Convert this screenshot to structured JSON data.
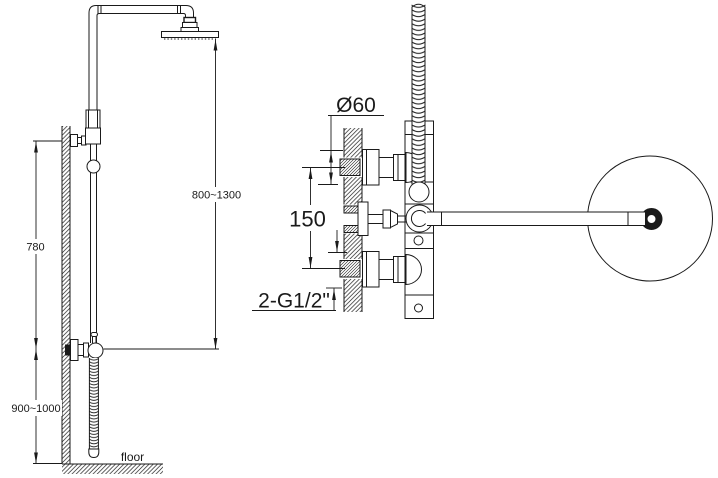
{
  "labels": {
    "side": {
      "bracket_height": "780",
      "head_height_range": "800~1300",
      "valve_height_range": "900~1000",
      "floor": "floor"
    },
    "front": {
      "escutcheon_diameter": "Ø60",
      "inlet_spacing": "150",
      "thread_spec": "2-G1/2\""
    }
  }
}
